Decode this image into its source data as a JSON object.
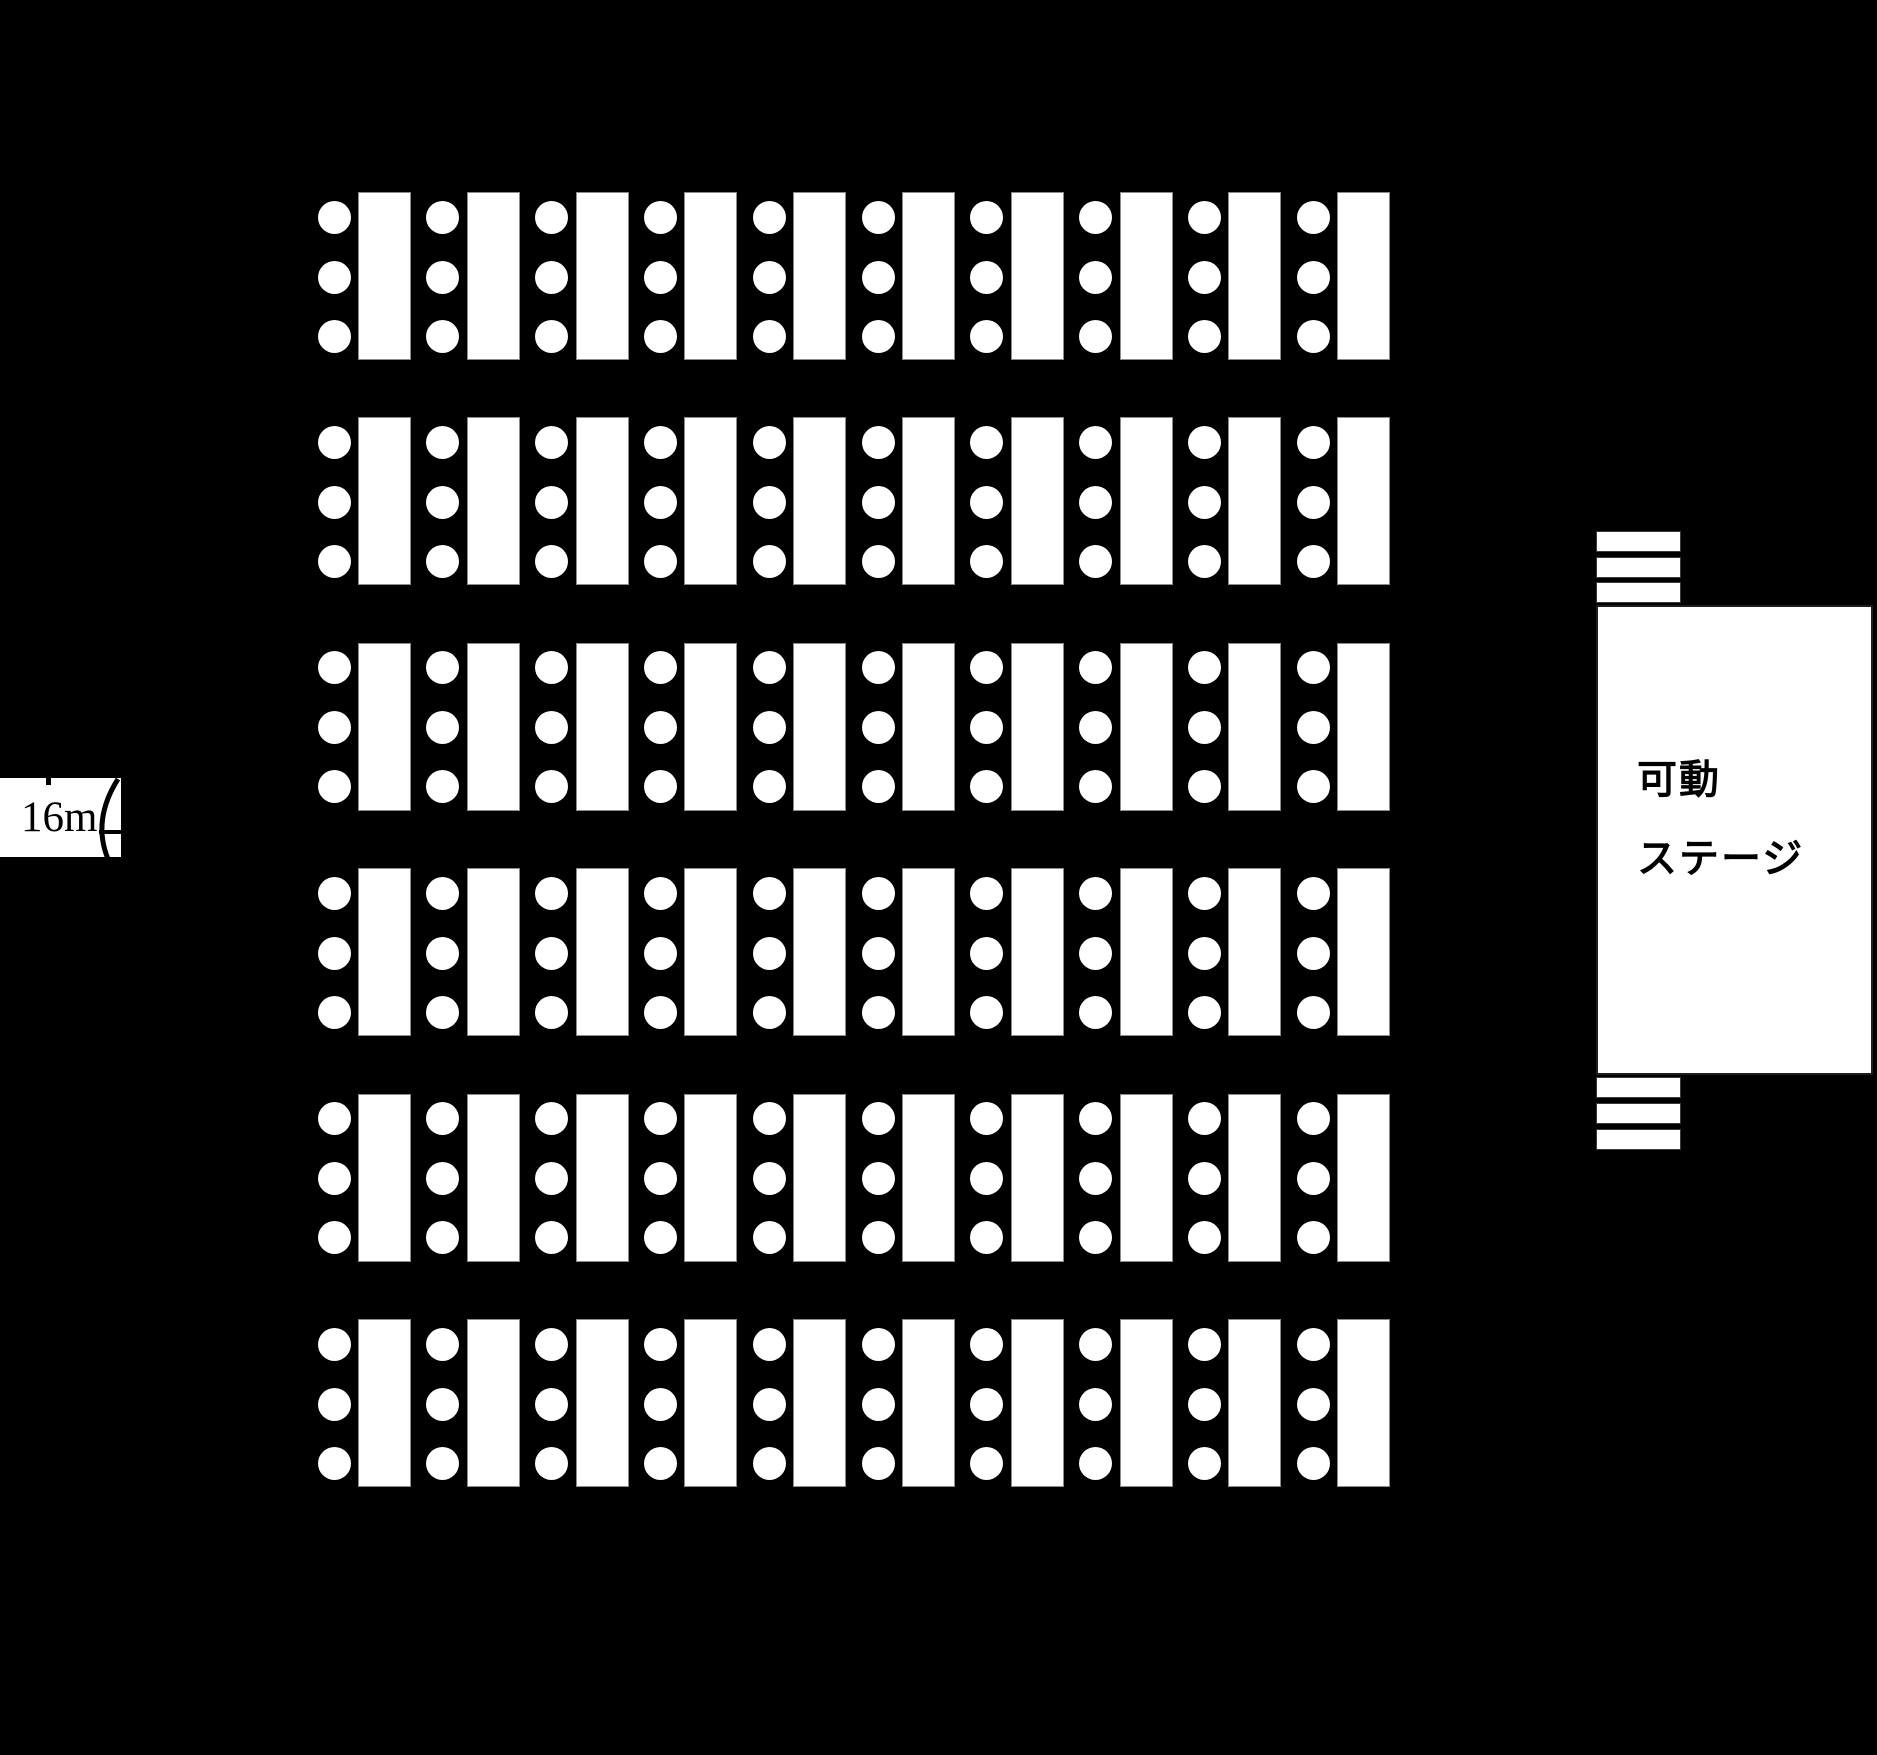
{
  "diagram": {
    "kind": "hall-floor-plan",
    "colors": {
      "background": "#000000",
      "shape_fill": "#ffffff",
      "shape_outline": "#8a8a8a",
      "text": "#000000"
    },
    "seating": {
      "rows": 6,
      "columns": 10,
      "chairs_per_table": 3,
      "total_tables": 60,
      "total_chairs": 180
    },
    "stage": {
      "label_line1": "可動",
      "label_line2": "ステージ",
      "steps_above_count": 3,
      "steps_below_count": 3
    },
    "dimension": {
      "label": "16m"
    }
  }
}
